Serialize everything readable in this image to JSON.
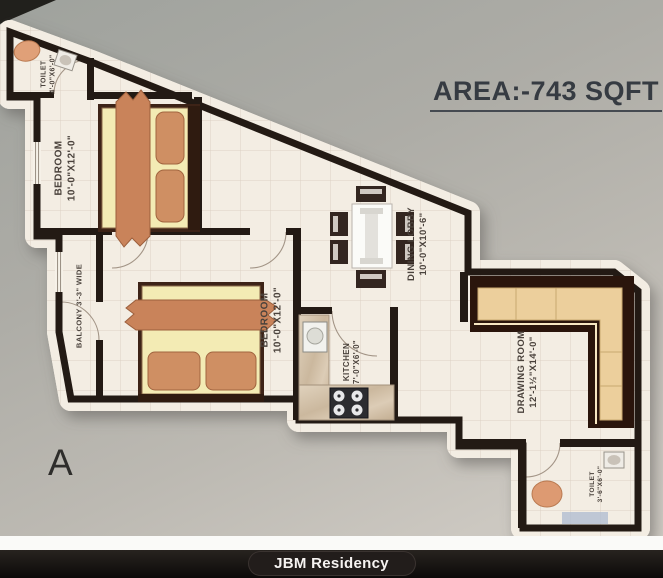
{
  "header": {
    "area_label": "AREA:-743 SQFT"
  },
  "plan": {
    "sheet_marker": "A",
    "rooms": {
      "toilet_top": {
        "name": "TOILET",
        "dims": "4'-0\"X6'-0\""
      },
      "bedroom1": {
        "name": "BEDROOM",
        "dims": "10'-0\"X12'-0\""
      },
      "balcony": {
        "name": "BALCONY",
        "dims": "3'-3\" WIDE"
      },
      "bedroom2": {
        "name": "BEDROOM",
        "dims": "10'-0\"X12'-0\""
      },
      "dining": {
        "name": "DINING LOBBY",
        "dims": "10'-0\"X10'-6\""
      },
      "kitchen": {
        "name": "KITCHEN",
        "dims": "7'-0\"X6'-0\""
      },
      "drawing": {
        "name": "DRAWING ROOM",
        "dims": "12'-1½\"X14'-0\""
      },
      "toilet_bottom": {
        "name": "TOILET",
        "dims": "3'-6\"X6'-0\""
      }
    }
  },
  "footer": {
    "brand": "JBM Residency"
  },
  "colors": {
    "wall": "#231a14",
    "paper": "#f3ede3",
    "grid_line": "#ddd1c5",
    "wood_accent": "#c9835a",
    "sofa_cushion": "#eccf9c",
    "title_text": "#363b42",
    "footer_bg": "#141110",
    "footer_text": "#f6f3f1"
  }
}
